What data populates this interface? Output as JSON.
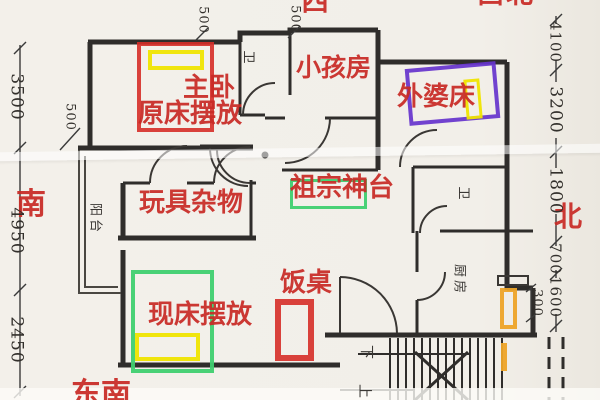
{
  "compass": {
    "west": "西",
    "northwest": "西北",
    "south": "南",
    "north": "北",
    "southeast": "东南"
  },
  "annotations": {
    "master_room": "主卧",
    "original_bed": "原床摆放",
    "kids_room": "小孩房",
    "grandma_bed": "外婆床",
    "toys_storage": "玩具杂物",
    "ancestral_altar": "祖宗神台",
    "dining_table": "饭桌",
    "current_bed": "现床摆放"
  },
  "plan_labels": {
    "bathroom_top": "卫",
    "bathroom_mid": "卫",
    "kitchen": "厨房",
    "balcony": "阳台",
    "stairs_down": "下",
    "stairs_up": "上"
  },
  "dimensions": {
    "left": [
      "3500",
      "4950",
      "2450"
    ],
    "right": [
      "4100",
      "3200",
      "1800",
      "700",
      "1600"
    ],
    "top_a": "500",
    "top_b": "500",
    "wall_left": "500",
    "stair_side": "300"
  },
  "colors": {
    "annotation_red": "#c92b26",
    "highlight_yellow": "#efe400",
    "highlight_green": "#3fcf70",
    "highlight_purple": "#6633cc",
    "highlight_orange": "#eda428",
    "wall_black": "#2f2d2b"
  }
}
